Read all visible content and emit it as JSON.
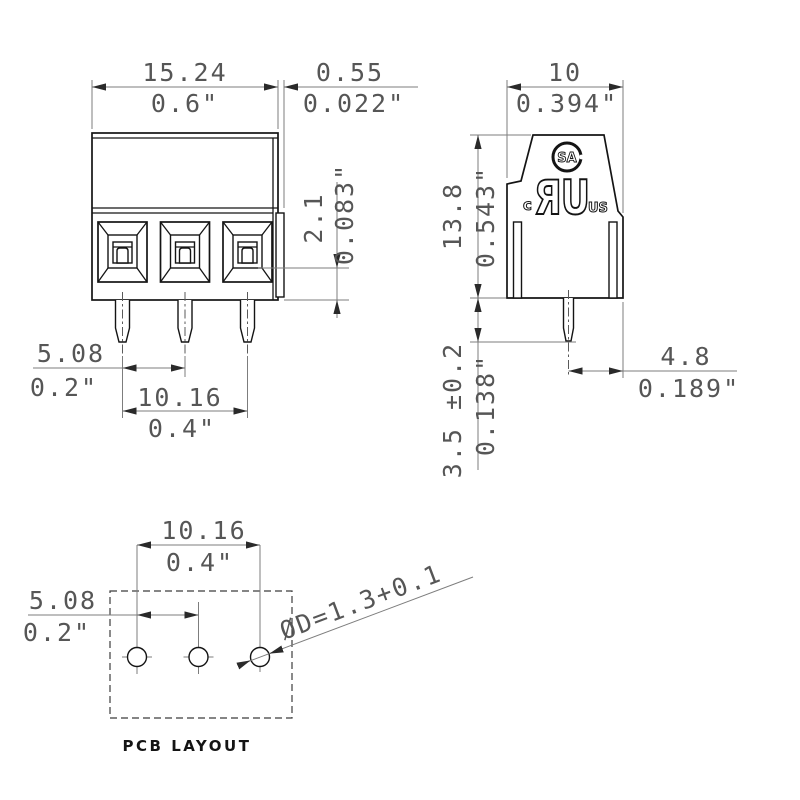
{
  "palette": {
    "background": "#ffffff",
    "ink": "#141414",
    "dim_lines": "#7d7d7d",
    "dim_text": "#565656"
  },
  "front_view": {
    "width": {
      "mm": "15.24",
      "inch": "0.6\""
    },
    "wall": {
      "mm": "0.55",
      "inch": "0.022\""
    },
    "recess": {
      "mm": "2.1",
      "inch": "0.083\""
    },
    "pin_pitch": {
      "mm": "5.08",
      "inch": "0.2\""
    },
    "pin_span": {
      "mm": "10.16",
      "inch": "0.4\""
    }
  },
  "side_view": {
    "width": {
      "mm": "10",
      "inch": "0.394\""
    },
    "height": {
      "mm": "13.8",
      "inch": "0.543\""
    },
    "pin_length": {
      "mm": "3.5 ±0.2",
      "inch": "0.138\""
    },
    "pin_offset": {
      "mm": "4.8",
      "inch": "0.189\""
    },
    "certifications": {
      "csa_monogram": "SA",
      "ul_prefix": "c",
      "ul_mark": "ЯU",
      "ul_suffix": "US"
    }
  },
  "pcb_layout": {
    "pin_span": {
      "mm": "10.16",
      "inch": "0.4\""
    },
    "pin_pitch": {
      "mm": "5.08",
      "inch": "0.2\""
    },
    "hole_diameter": "ØD=1.3+0.1",
    "caption": "PCB LAYOUT"
  }
}
